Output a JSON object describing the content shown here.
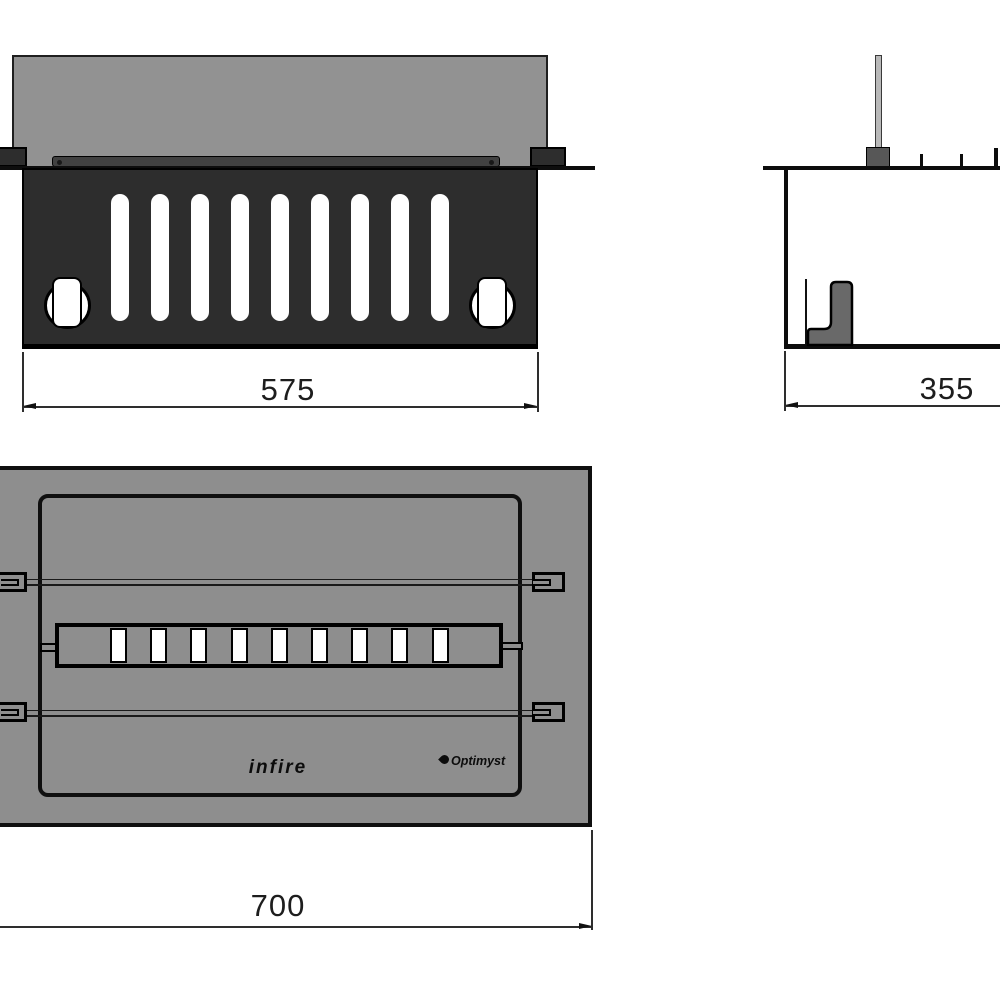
{
  "drawing": {
    "views": {
      "front": {
        "name": "front-view",
        "dimension": "575",
        "slot_count": 9
      },
      "side": {
        "name": "side-view",
        "dimension": "355"
      },
      "top": {
        "name": "top-view",
        "dimension": "700",
        "slot_count": 9,
        "logos": {
          "brand": "infire",
          "technology": "Optimyst",
          "technology_icon": "flame-icon"
        }
      }
    },
    "colors": {
      "front_panel_dark": "#2d2d2d",
      "back_panel_gray": "#929292",
      "body_gray": "#8e8e8e",
      "rod_light_gray": "#b9b9b9",
      "line_black": "#0f0f0f",
      "background": "#ffffff"
    }
  }
}
